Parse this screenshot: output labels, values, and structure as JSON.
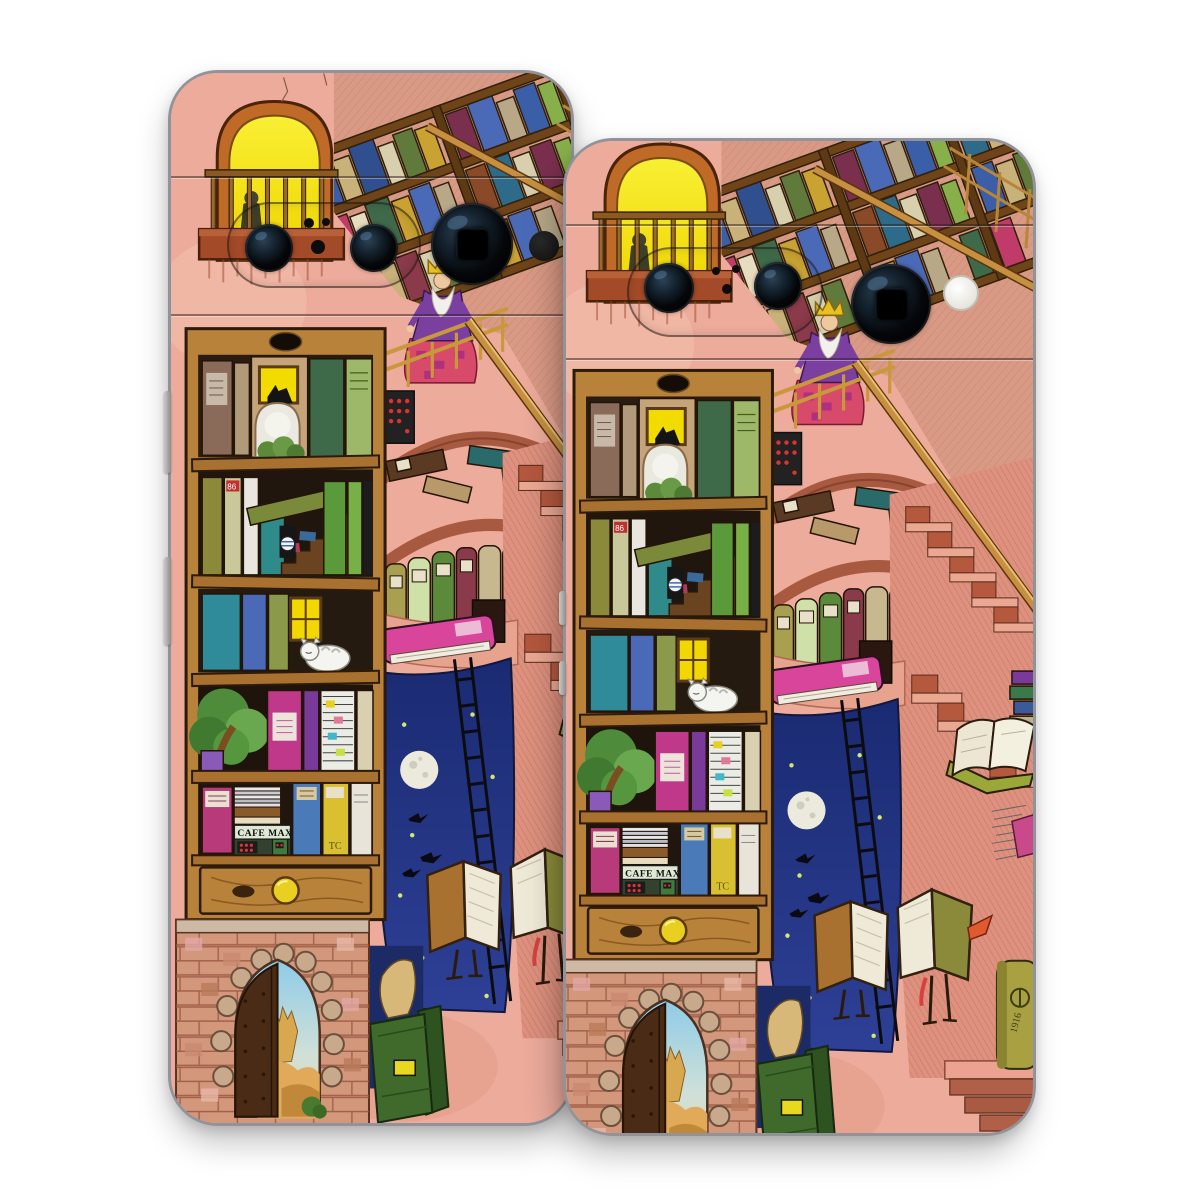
{
  "product": {
    "type": "phone skin decal product photo",
    "background_color": "#ffffff",
    "phone_count": 2,
    "left_phone": {
      "cameras": "two lenses in pill plus large telephoto lens",
      "flash": "dark",
      "side_buttons": 2
    },
    "right_phone": {
      "cameras": "two lenses in pill plus large telephoto lens",
      "flash": "white",
      "side_buttons": 2
    }
  },
  "artwork": {
    "style": "whimsical watercolor library illustration",
    "cafe_sign": "CAFE MAX",
    "yellow_book_monogram": "TC",
    "red_book_label": "86",
    "olive_book_year": "1916",
    "elements": [
      "arched window with yellow light and silhouette figure",
      "wooden balcony",
      "tilted ceiling bookshelves",
      "king with gold crown on staircase",
      "tall bookshelf with staircase, sleeping cat, tree and CAFE MAX shopfront",
      "wooden drawer with yellow knob",
      "brick wall with scalloped Moorish archway and open door to desert",
      "night sky opening with moon, fireflies and ladder",
      "book creatures with bird legs reading",
      "Escher-like pink staircases"
    ],
    "palette": {
      "wall_pink": "#ecab9b",
      "window_yellow": "#f2dc00",
      "frame_orange": "#c06a28",
      "wood": "#a9712f",
      "night_blue": "#1d2d72",
      "brick": "#cf8a6c",
      "magenta_book": "#c0388a",
      "olive_book": "#a8a041",
      "teal_book": "#2f8a9a"
    }
  }
}
